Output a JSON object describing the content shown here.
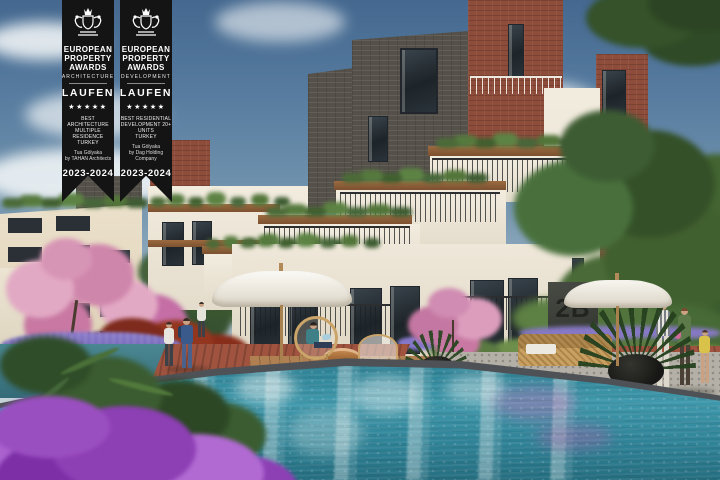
{
  "awards": {
    "architecture": {
      "organization": "EUROPEAN\nPROPERTY\nAWARDS",
      "category": "ARCHITECTURE",
      "sponsor": "LAUFEN",
      "stars": "★★★★★",
      "award_title": "BEST ARCHITECTURE\nMULTIPLE RESIDENCE\nTURKEY",
      "winner": "Tua Gölyaka\nby TAHAN Architects",
      "years": "2023-2024"
    },
    "development": {
      "organization": "EUROPEAN\nPROPERTY\nAWARDS",
      "category": "DEVELOPMENT",
      "sponsor": "LAUFEN",
      "stars": "★★★★★",
      "award_title": "BEST RESIDENTIAL\nDEVELOPMENT 20+ UNITS\nTURKEY",
      "winner": "Tua Gölyaka\nby Dag Holding Company",
      "years": "2023-2024"
    }
  },
  "scene": {
    "block_label": "2B"
  },
  "palette": {
    "sky_top": "#44688f",
    "sky_horizon": "#d3dcdf",
    "ribbon_black": "#141414",
    "stucco_white": "#efe8da",
    "brick_red": "#8e4c3b",
    "brick_dark": "#55514a",
    "wood_trim": "#8a5c38",
    "foliage_green": "#4c6b38",
    "blossom_pink": "#d795b5",
    "bougainvillea_purple": "#9a4fc0",
    "lavender": "#7e6fc0",
    "pool_water": "#3f98ab",
    "pool_deep": "#1f6b7e",
    "paving_brick": "#a05440",
    "pebble_gray": "#b5b0a7",
    "umbrella_white": "#f2efe8"
  }
}
